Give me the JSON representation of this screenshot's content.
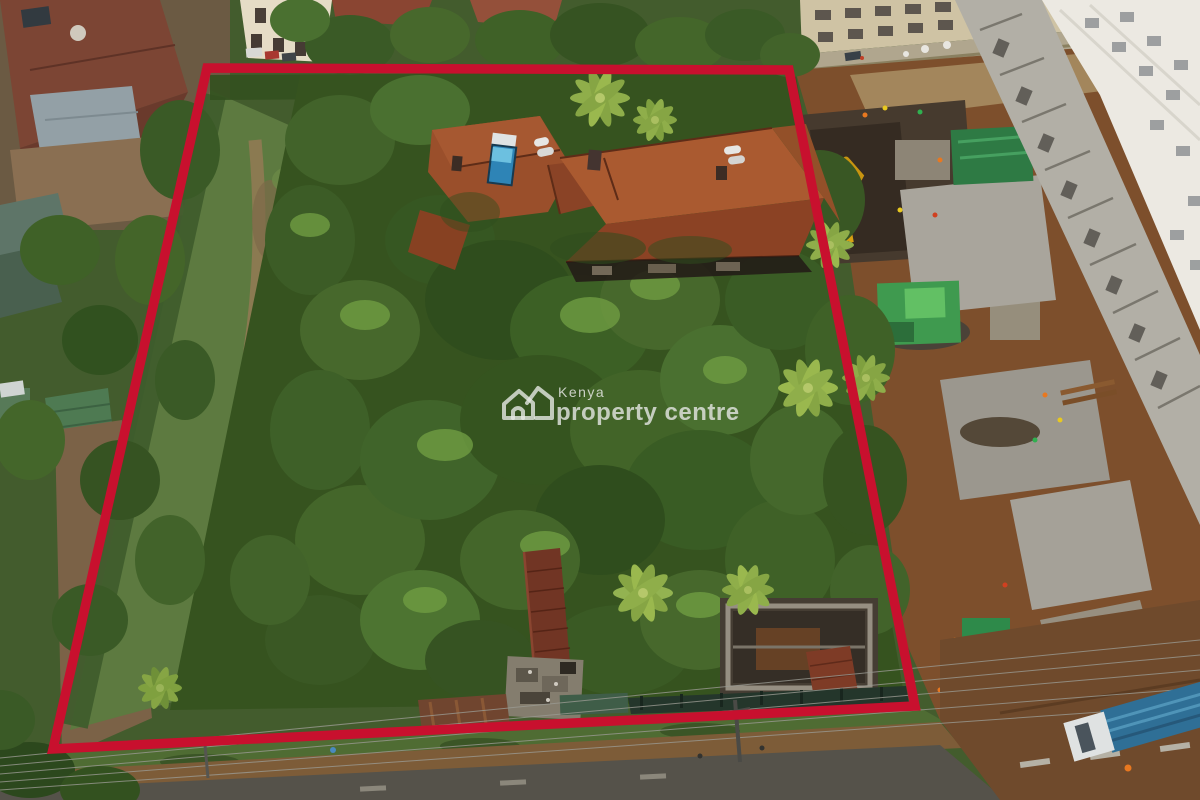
{
  "watermark": {
    "logo_icon": "kenya-property-centre-house-logo",
    "line1": "Kenya",
    "line2": "property centre",
    "text_color": "#dededc"
  },
  "boundary": {
    "points": "207,68 789,70 915,706 53,749",
    "color": "#c8102e",
    "stroke_width": 9.5
  },
  "palette": {
    "foliage_dark": "#2f4d1d",
    "foliage_mid": "#44662a",
    "roof_terracotta": "#9a4f2b",
    "construction_dirt": "#7d4f2c",
    "concrete": "#a9a59c",
    "asphalt": "#55524a",
    "white_tower": "#ece9e2",
    "truck_blue": "#2f6f96",
    "pool_blue": "#2e84b6"
  }
}
